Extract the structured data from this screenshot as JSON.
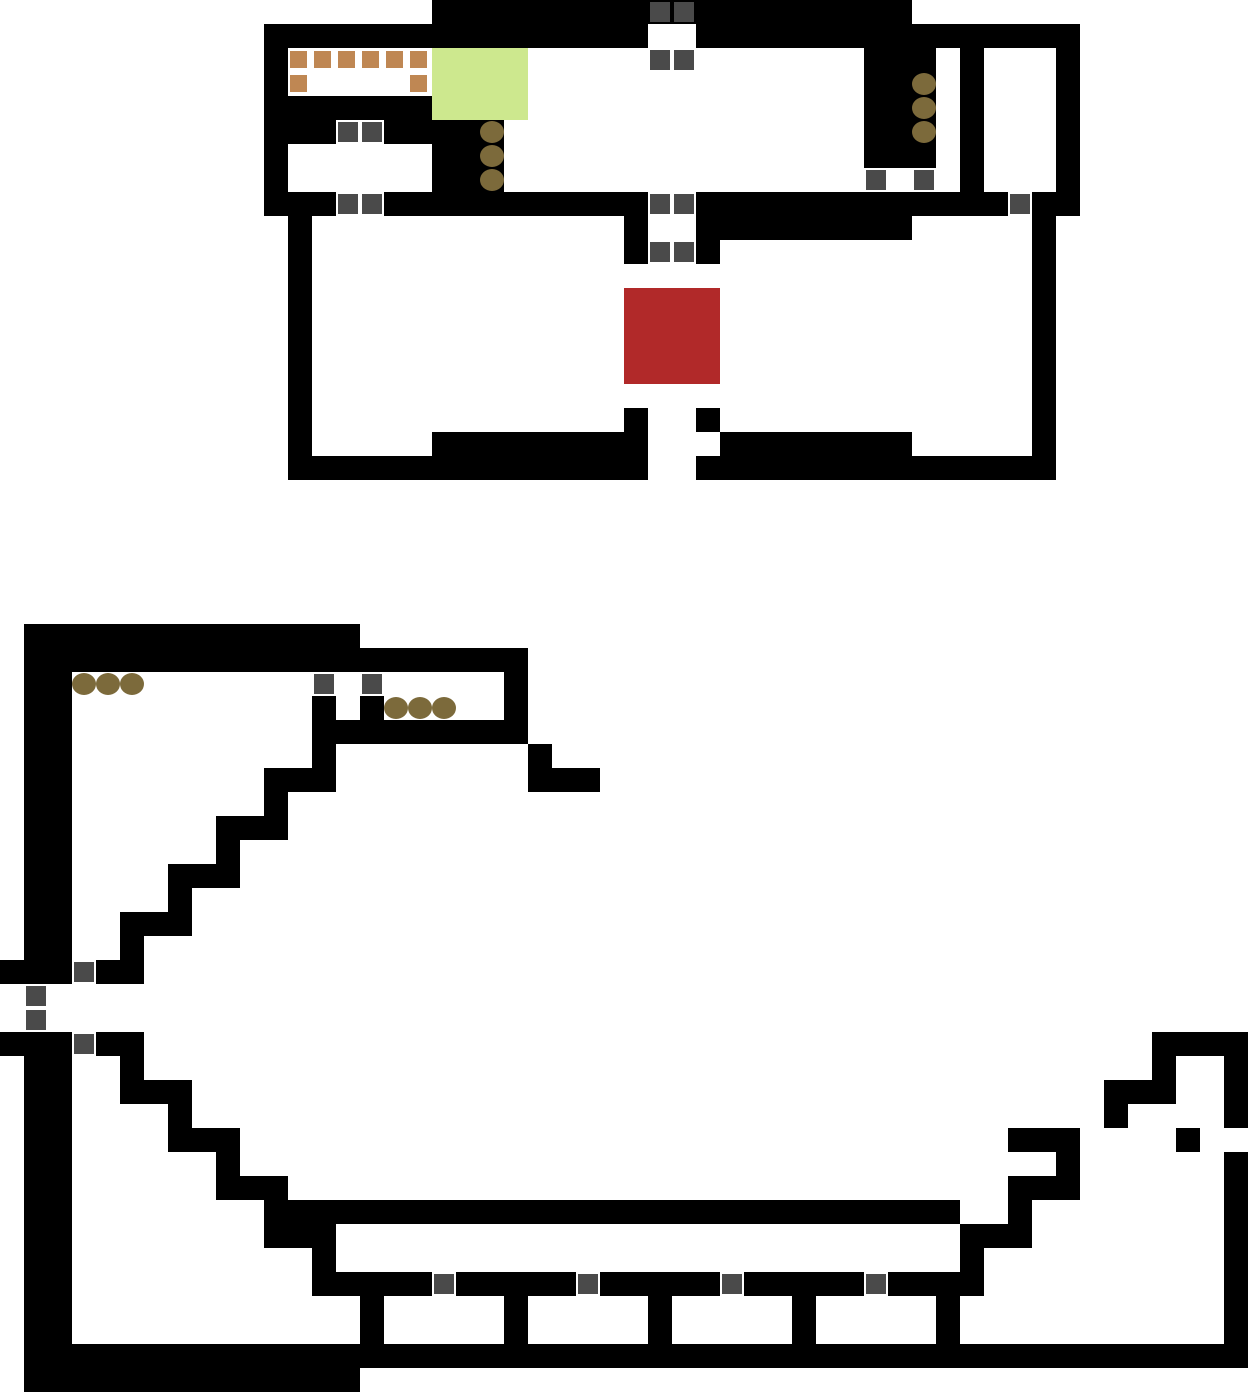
{
  "canvas": {
    "width": 1249,
    "height": 1393,
    "tile_size": 24,
    "background_color": "#ffffff"
  },
  "colors": {
    "wall": "#000000",
    "open": "#ffffff",
    "door": "#4a4a4a",
    "boulder": "#7c6a3b",
    "crate": "#bf8753",
    "green_zone": "#cde88e",
    "red_zone": "#b12929"
  },
  "legend": {
    "#": "wall",
    ".": "open-floor-or-unexplored",
    "door": "door-icon (gray square)",
    "boulder": "boulder-icon (brown circle)",
    "crate": "crate-icon (orange square)",
    "green_zone": "highlighted-green-area",
    "red_zone": "highlighted-red-area"
  },
  "map_grid": {
    "columns": 52,
    "rows": 58,
    "rows_data": [
      "..................####################..............",
      "...........################..################.......",
      "...........#........................###.#...#.......",
      "...........#........................###.#...#.......",
      "...........#######..................###.#...#.......",
      "...........###..#####...............###.#...#.......",
      "...........#......###...............###.#...#.......",
      "...........#......###...................#...#.......",
      "...........###..###########..#############.##.......",
      "............#.............#..#########.....#........",
      "............#.............#..#.............#........",
      "............#..............................#........",
      "............#..............................#........",
      "............#..............................#........",
      "............#..............................#........",
      "............#..............................#........",
      "............#..............................#........",
      "............#.............#..#.............#........",
      "............#.....#########...########.....#........",
      "............###############..###############........",
      "....................................................",
      "....................................................",
      "....................................................",
      "....................................................",
      "....................................................",
      "....................................................",
      ".##############......................................",
      ".#####################..............................",
      ".##..................#..............................",
      ".##..........#.#.....#..............................",
      ".##..........#########..............................",
      ".##..........#........#.............................",
      ".##........###........###...........................",
      ".##........#........................................",
      ".##......###........................................",
      ".##......#..........................................",
      ".##....###..........................................",
      ".##....#............................................",
      ".##..###............................................",
      ".##..#..............................................",
      "###.##..............................................",
      "....................................................",
      "....................................................",
      "###.##..........................................####",
      ".##..#..........................................#..#",
      ".##..###......................................###..#",
      ".##....#......................................#....#",
      ".##....###................................###....#",
      ".##......#..................................#......#",
      ".##......###..............................###......#",
      ".##........#############################..#........#",
      ".##........###..........................###........#",
      ".##..........#..........................#..........#",
      ".##..........#####.#####.#####.#####.####..........#",
      ".##............#.....#.....#.....#.....#...........#",
      ".##............#.....#.....#.....#.....#...........#",
      ".###################################################",
      ".##############......................................"
    ]
  },
  "zones": [
    {
      "name": "green-zone",
      "color_key": "green_zone",
      "col": 18,
      "row": 2,
      "width_tiles": 4,
      "height_tiles": 3
    },
    {
      "name": "red-zone",
      "color_key": "red_zone",
      "col": 26,
      "row": 12,
      "width_tiles": 4,
      "height_tiles": 4
    }
  ],
  "doors": [
    [
      27,
      0
    ],
    [
      28,
      0
    ],
    [
      27,
      2
    ],
    [
      28,
      2
    ],
    [
      14,
      5
    ],
    [
      15,
      5
    ],
    [
      36,
      7
    ],
    [
      38,
      7
    ],
    [
      14,
      8
    ],
    [
      15,
      8
    ],
    [
      27,
      8
    ],
    [
      28,
      8
    ],
    [
      42,
      8
    ],
    [
      27,
      10
    ],
    [
      28,
      10
    ],
    [
      13,
      28
    ],
    [
      15,
      28
    ],
    [
      3,
      40
    ],
    [
      1,
      41
    ],
    [
      1,
      42
    ],
    [
      3,
      43
    ],
    [
      18,
      53
    ],
    [
      24,
      53
    ],
    [
      30,
      53
    ],
    [
      36,
      53
    ]
  ],
  "boulders": [
    [
      20,
      5
    ],
    [
      20,
      6
    ],
    [
      20,
      7
    ],
    [
      38,
      3
    ],
    [
      38,
      4
    ],
    [
      38,
      5
    ],
    [
      3,
      28
    ],
    [
      4,
      28
    ],
    [
      5,
      28
    ],
    [
      16,
      29
    ],
    [
      17,
      29
    ],
    [
      18,
      29
    ]
  ],
  "crates": [
    [
      12,
      2
    ],
    [
      13,
      2
    ],
    [
      14,
      2
    ],
    [
      15,
      2
    ],
    [
      16,
      2
    ],
    [
      17,
      2
    ],
    [
      12,
      3
    ],
    [
      17,
      3
    ]
  ]
}
